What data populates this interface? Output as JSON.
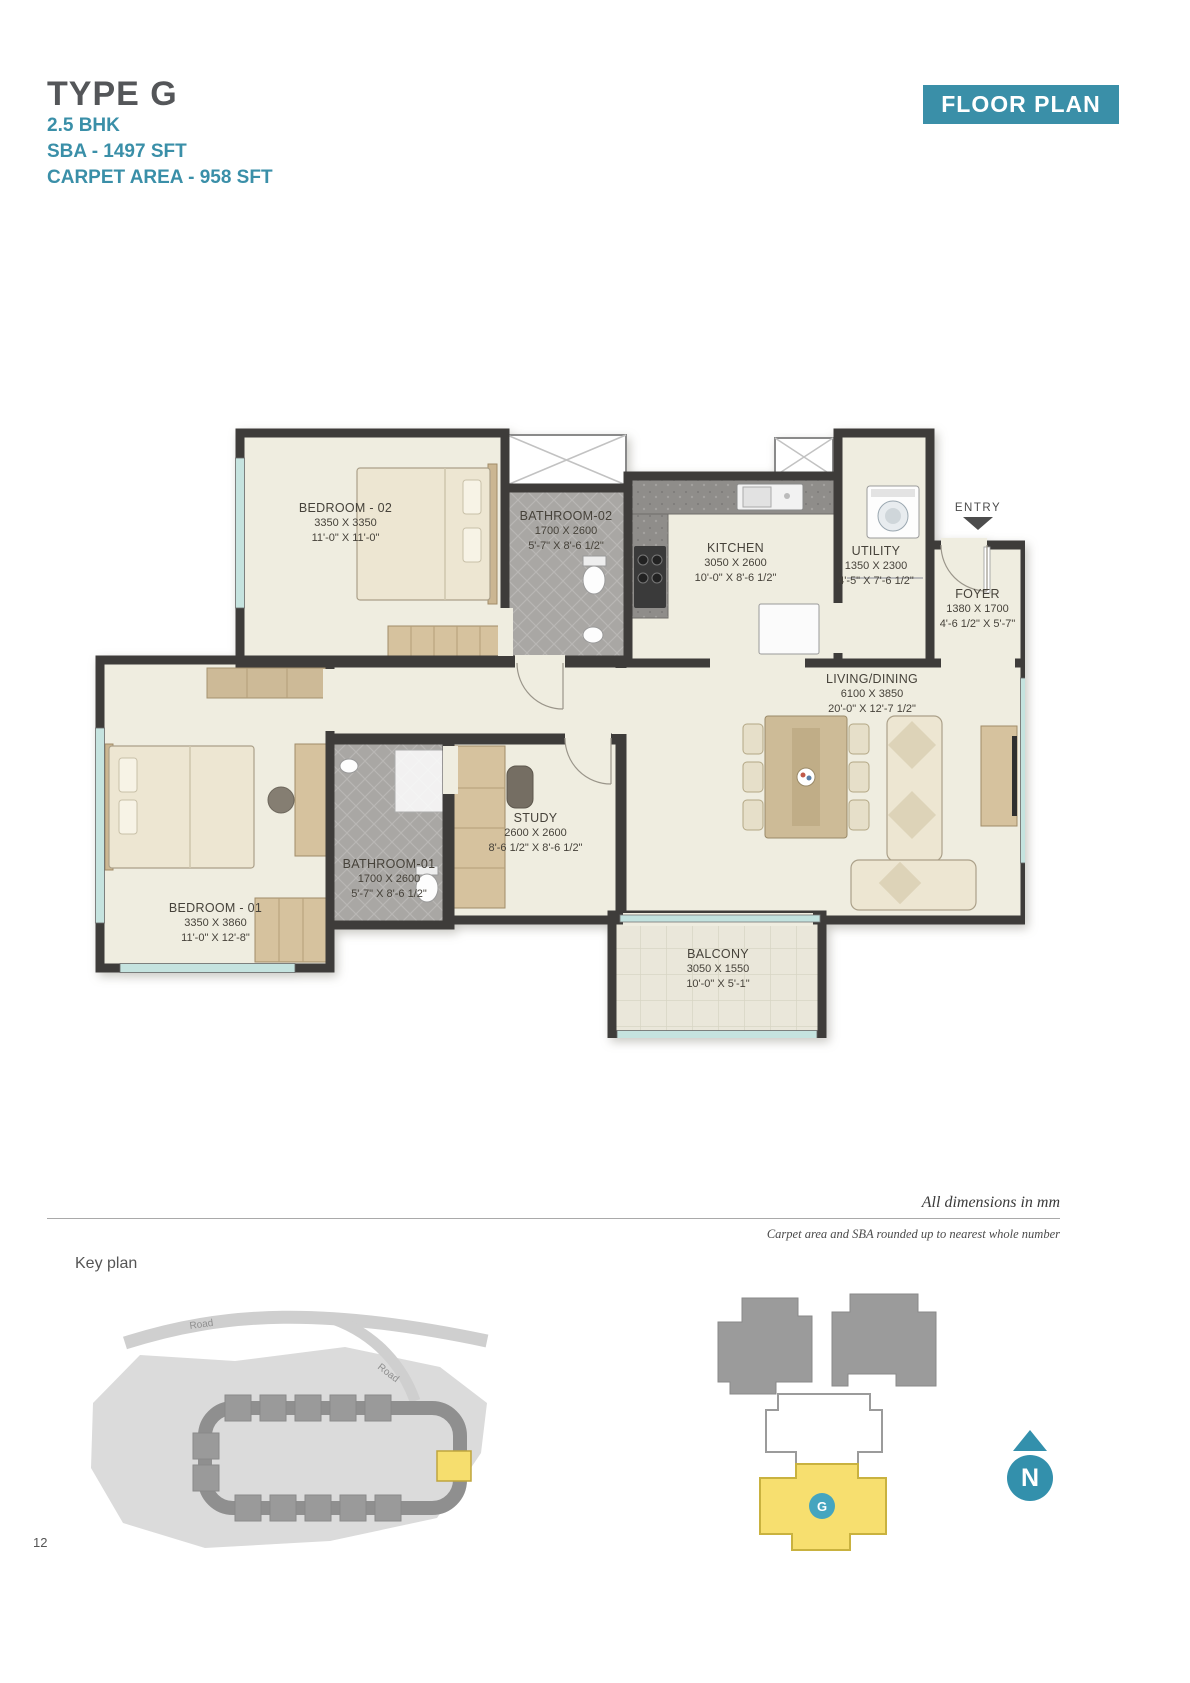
{
  "header": {
    "type_title": "TYPE G",
    "bhk": "2.5 BHK",
    "sba": "SBA - 1497 SFT",
    "carpet": "CARPET AREA - 958 SFT",
    "badge": "FLOOR PLAN"
  },
  "plan": {
    "entry_label": "ENTRY",
    "rooms": {
      "bedroom2": {
        "name": "BEDROOM - 02",
        "mm": "3350 X 3350",
        "ft": "11'-0\" X 11'-0\""
      },
      "bathroom2": {
        "name": "BATHROOM-02",
        "mm": "1700 X 2600",
        "ft": "5'-7\" X 8'-6 1/2\""
      },
      "kitchen": {
        "name": "KITCHEN",
        "mm": "3050 X 2600",
        "ft": "10'-0\" X 8'-6 1/2\""
      },
      "utility": {
        "name": "UTILITY",
        "mm": "1350 X 2300",
        "ft": "4'-5\" X 7'-6 1/2\""
      },
      "foyer": {
        "name": "FOYER",
        "mm": "1380 X 1700",
        "ft": "4'-6 1/2\" X 5'-7\""
      },
      "living": {
        "name": "LIVING/DINING",
        "mm": "6100 X 3850",
        "ft": "20'-0\" X 12'-7 1/2\""
      },
      "study": {
        "name": "STUDY",
        "mm": "2600 X 2600",
        "ft": "8'-6 1/2\" X 8'-6 1/2\""
      },
      "bathroom1": {
        "name": "BATHROOM-01",
        "mm": "1700 X 2600",
        "ft": "5'-7\" X 8'-6 1/2\""
      },
      "bedroom1": {
        "name": "BEDROOM - 01",
        "mm": "3350 X 3860",
        "ft": "11'-0\" X 12'-8\""
      },
      "balcony": {
        "name": "BALCONY",
        "mm": "3050 X 1550",
        "ft": "10'-0\" X 5'-1\""
      }
    }
  },
  "notes": {
    "dimensions": "All dimensions in mm",
    "rounding": "Carpet area and SBA rounded up to nearest whole number"
  },
  "keyplan": {
    "label": "Key plan",
    "road_label_1": "Road",
    "road_label_2": "Road",
    "unit_marker": "G",
    "north": "N"
  },
  "page_number": "12",
  "colors": {
    "accent_teal": "#3A8FA8",
    "wall_dark": "#3E3C3A",
    "highlight_yellow": "#F7DF6F",
    "floor_cream": "#EFEDE0"
  }
}
